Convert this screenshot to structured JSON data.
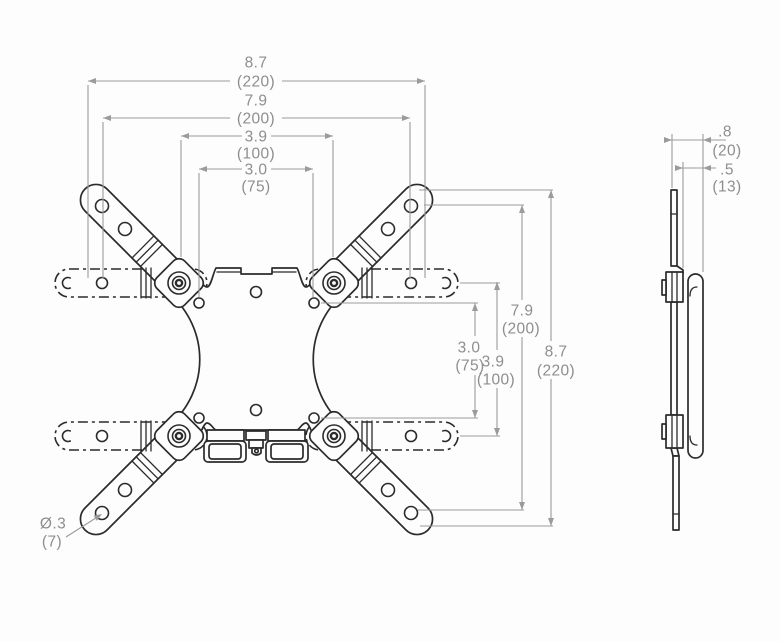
{
  "drawing_title": "VESA adapter bracket dimension drawing",
  "dims_top": [
    {
      "inches": "8.7",
      "mm": "(220)"
    },
    {
      "inches": "7.9",
      "mm": "(200)"
    },
    {
      "inches": "3.9",
      "mm": "(100)"
    },
    {
      "inches": "3.0",
      "mm": "(75)"
    }
  ],
  "dims_right": [
    {
      "inches": "3.0",
      "mm": "(75)"
    },
    {
      "inches": "3.9",
      "mm": "(100)"
    },
    {
      "inches": "7.9",
      "mm": "(200)"
    },
    {
      "inches": "8.7",
      "mm": "(220)"
    }
  ],
  "dims_side": [
    {
      "inches": ".8",
      "mm": "(20)"
    },
    {
      "inches": ".5",
      "mm": "(13)"
    }
  ],
  "hole_callout": {
    "diameter_inches": "Ø.3",
    "diameter_mm": "(7)"
  },
  "colors": {
    "line": "#2b2b2b",
    "dim_line": "#9b9b9b",
    "dim_text": "#8e8e8e",
    "background": "#fdfdfd"
  }
}
